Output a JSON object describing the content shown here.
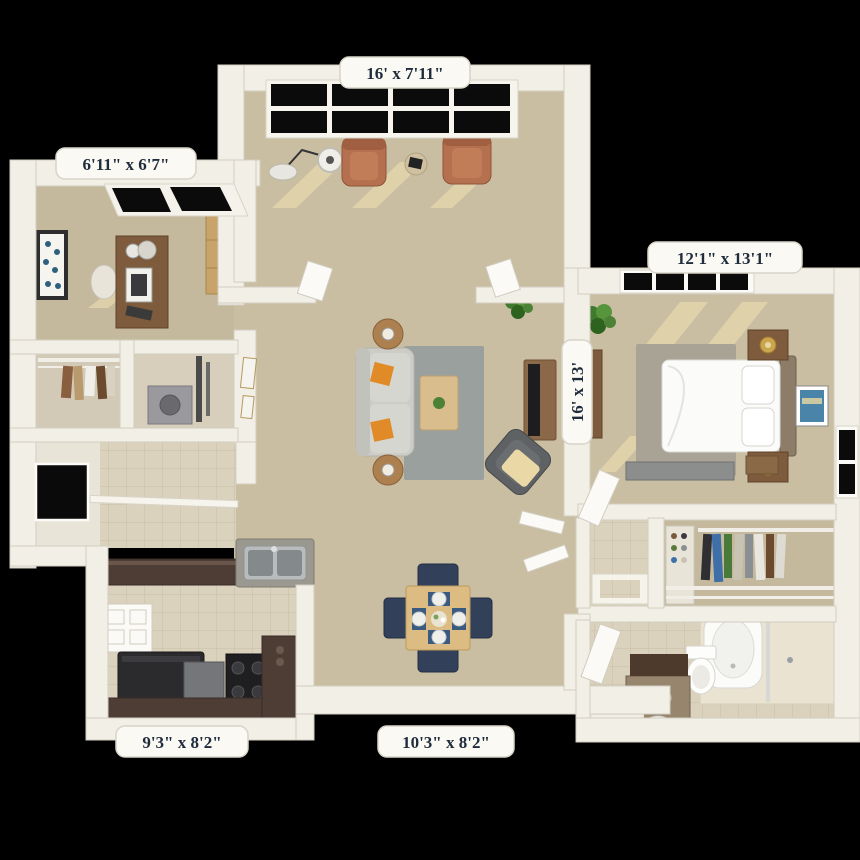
{
  "title": "Apartment 3D floor plan",
  "colors": {
    "background": "#000000",
    "wall": "#f2efe6",
    "carpet": "#c9bea1",
    "tile": "#dbd2bd",
    "label_bg": "#fbf9f3",
    "label_text": "#1e2c3c",
    "rug_gray": "#9aa09e",
    "armchair_terracotta": "#b5714f",
    "sofa_gray": "#cdccc7",
    "pillow_orange": "#e08a28",
    "counter_espresso": "#4e3d35",
    "appliance_black": "#222226",
    "dining_chair_navy": "#32405a",
    "plant_green": "#4c8136",
    "bed_white": "#fbfbf9"
  },
  "rooms": [
    {
      "name": "sunroom",
      "dimensions": "16' x 7'11\"",
      "furniture": [
        "armchair",
        "armchair",
        "floor-lamp",
        "side-table",
        "window-wall"
      ]
    },
    {
      "name": "office",
      "dimensions": "6'11\" x 6'7\"",
      "furniture": [
        "desk",
        "desk-chair",
        "desk-lamp",
        "monitor",
        "wall-art",
        "bookcase",
        "window"
      ]
    },
    {
      "name": "bedroom",
      "dimensions": "12'1\" x 13'1\"",
      "furniture": [
        "bed",
        "nightstand",
        "nightstand",
        "table-lamp",
        "table-lamp",
        "dresser",
        "wall-art",
        "rug",
        "potted-plant",
        "windows"
      ]
    },
    {
      "name": "living-room",
      "dimensions": "16' x 13'",
      "furniture": [
        "sofa",
        "end-table",
        "end-table",
        "coffee-table",
        "rug",
        "tv-console",
        "accent-chair",
        "potted-plant"
      ]
    },
    {
      "name": "kitchen",
      "dimensions": "9'3\" x 8'2\"",
      "furniture": [
        "refrigerator",
        "stove",
        "dishwasher",
        "double-sink",
        "bar-counter",
        "pantry-doors"
      ]
    },
    {
      "name": "dining-area",
      "dimensions": "10'3\" x 8'2\"",
      "furniture": [
        "dining-table",
        "dining-chair",
        "dining-chair",
        "dining-chair",
        "dining-chair",
        "place-settings"
      ]
    }
  ],
  "unlabeled_areas": [
    "entry-foyer",
    "closet",
    "laundry-utility",
    "hallway",
    "walk-in-closet",
    "bathroom",
    "vanity-nook",
    "linen-closet"
  ]
}
